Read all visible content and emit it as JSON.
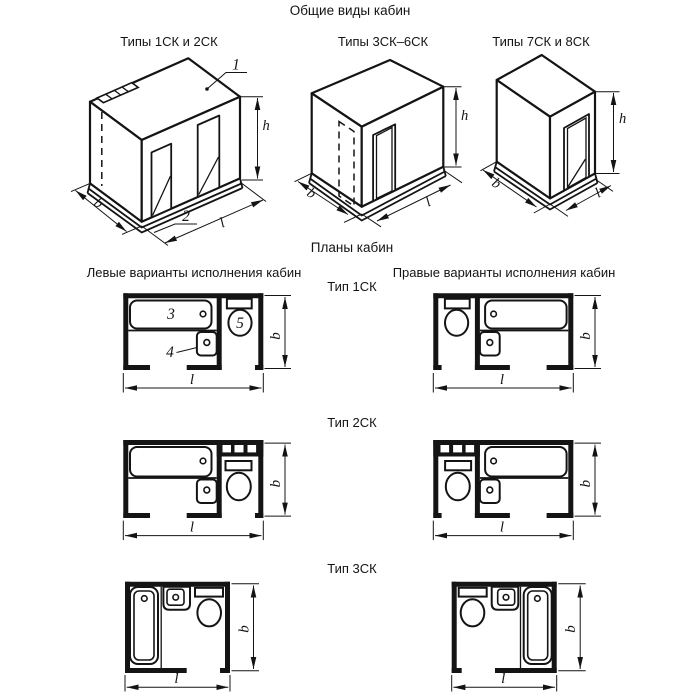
{
  "title": "Общие виды кабин",
  "isometric": {
    "view1_label": "Типы 1СК и 2СК",
    "view2_label": "Типы 3СК–6СК",
    "view3_label": "Типы 7СК и 8СК"
  },
  "plans": {
    "title": "Планы кабин",
    "left_column": "Левые варианты исполнения кабин",
    "right_column": "Правые варианты исполнения кабин",
    "type1": "Тип 1СК",
    "type2": "Тип 2СК",
    "type3": "Тип 3СК"
  },
  "dimensions": {
    "b": "b",
    "l": "l",
    "h": "h"
  },
  "callouts": {
    "roof_panel": "1",
    "base_panel": "2",
    "bathtub": "3",
    "washbasin": "4",
    "toilet": "5"
  },
  "colors": {
    "ink": "#141414",
    "paper": "#ffffff"
  }
}
